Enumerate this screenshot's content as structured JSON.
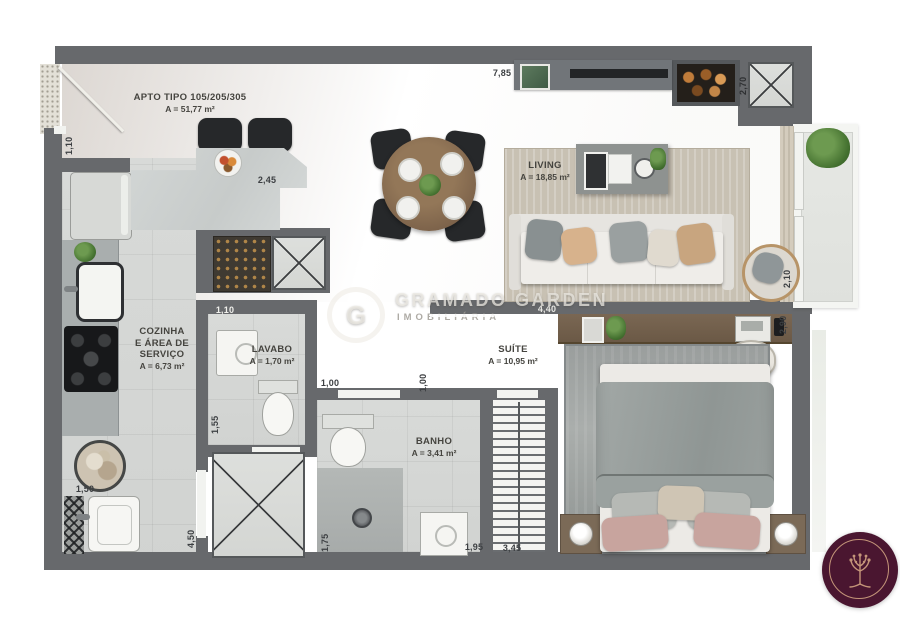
{
  "meta": {
    "brand": "GRAMADO GARDEN",
    "brand_sub": "IMOBILIÁRIA",
    "logo_letter": "G"
  },
  "plan": {
    "title": "APTO TIPO 105/205/305",
    "title_area": "A = 51,77 m²",
    "rooms": {
      "living": {
        "name": "LIVING",
        "area": "A = 18,85 m²"
      },
      "cozinha": {
        "name": "COZINHA\nE ÁREA DE\nSERVIÇO",
        "area": "A = 6,73 m²"
      },
      "lavabo": {
        "name": "LAVABO",
        "area": "A = 1,70 m²"
      },
      "banho": {
        "name": "BANHO",
        "area": "A = 3,41 m²"
      },
      "suite": {
        "name": "SUÍTE",
        "area": "A = 10,95 m²"
      }
    },
    "dims": {
      "top_width": "7,85",
      "fireplace_depth": "2,70",
      "entry": "1,10",
      "counter": "2,45",
      "lavabo_width": "1,10",
      "lavabo_depth": "1,55",
      "hall_a": "1,00",
      "hall_b": "1,00",
      "suite_width": "4,40",
      "balcony_depth": "2,10",
      "suite_depth": "2,90",
      "service_width": "1,50",
      "service_depth": "4,50",
      "banho_depth": "1,75",
      "banho_width": "1,95",
      "closet_depth": "3,45"
    },
    "colors": {
      "wall": "#67696c",
      "wood": "#96897b",
      "tile": "#d5d7d5",
      "logo_bg": "#4a1630",
      "logo_ring": "#c49579"
    }
  }
}
